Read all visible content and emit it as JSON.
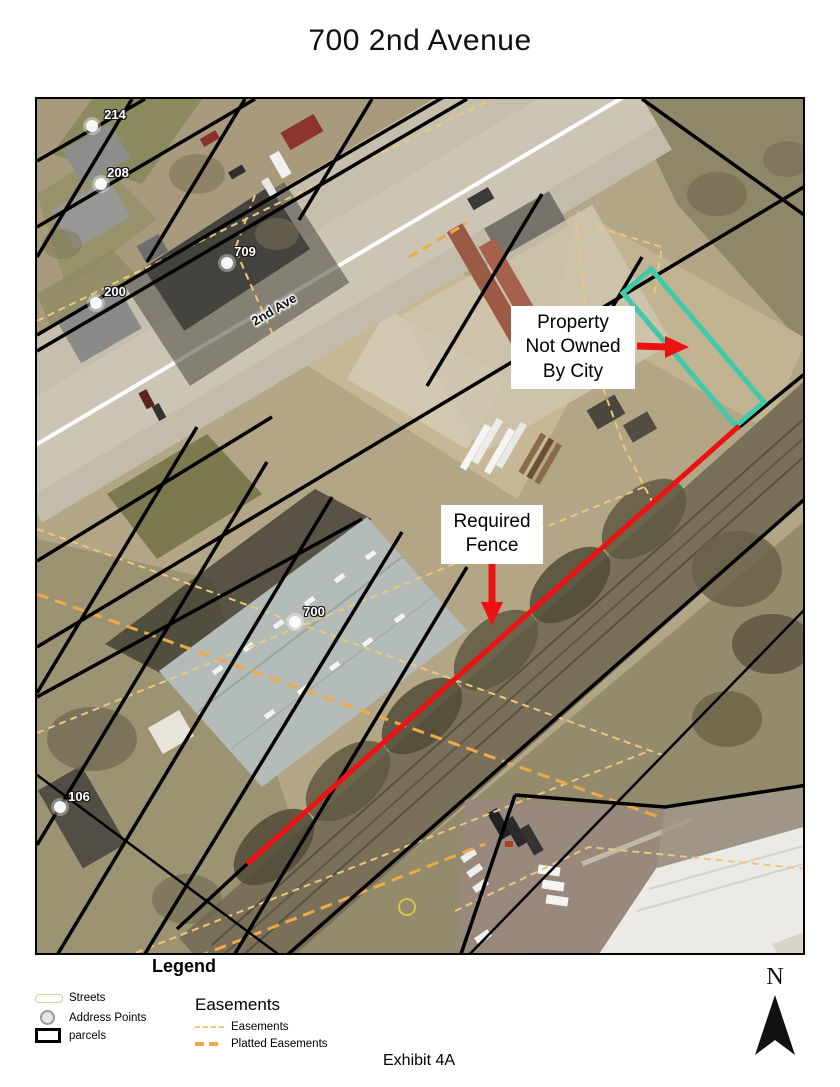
{
  "page": {
    "title": "700 2nd Avenue",
    "exhibit_label": "Exhibit 4A"
  },
  "map": {
    "street_label": "2nd Ave",
    "address_points": [
      {
        "label": "214"
      },
      {
        "label": "208"
      },
      {
        "label": "709"
      },
      {
        "label": "200"
      },
      {
        "label": "700"
      },
      {
        "label": "106"
      }
    ],
    "annotations": {
      "property": {
        "lines": [
          "Property",
          "Not Owned",
          "By City"
        ]
      },
      "fence": {
        "lines": [
          "Required",
          "Fence"
        ]
      }
    },
    "colors": {
      "fence_line": "#ed1111",
      "property_outline": "#40c8ab",
      "parcel_line": "#000000",
      "easement_dash": "#edc87c",
      "platted_easement_dash": "#efaa48"
    }
  },
  "legend": {
    "title": "Legend",
    "items": [
      {
        "label": "Streets"
      },
      {
        "label": "Address Points"
      },
      {
        "label": "parcels"
      }
    ],
    "easements": {
      "title": "Easements",
      "items": [
        {
          "label": "Easements"
        },
        {
          "label": "Platted Easements"
        }
      ]
    }
  },
  "north_arrow": {
    "label": "N"
  }
}
